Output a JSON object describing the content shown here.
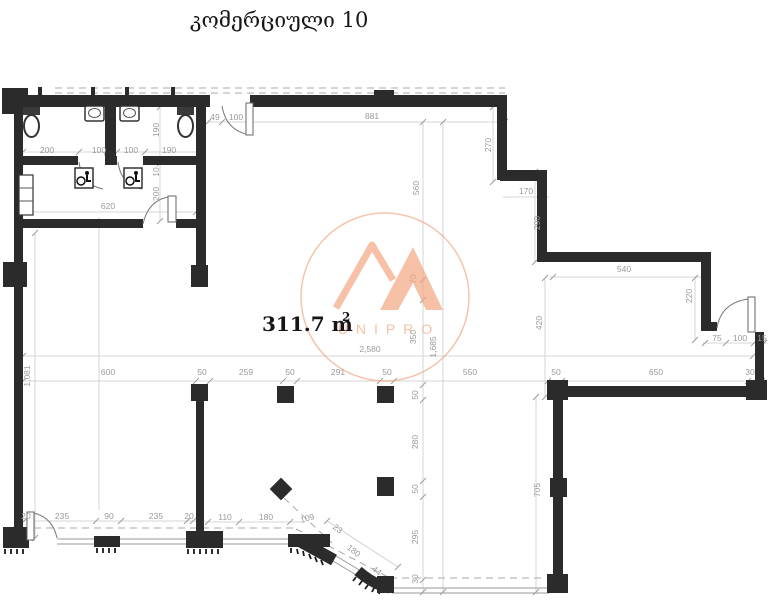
{
  "title": "კომერციული 10",
  "area_label": {
    "value": "311.7 m",
    "superscript": "2"
  },
  "watermark": {
    "brand": "UNIPRO"
  },
  "colors": {
    "wall": "#2b2b2b",
    "dimension_text": "#9a9a9a",
    "reference_line": "#c9c9c9",
    "dashed_line": "#a9a9a9",
    "watermark_orange": "#f2a47c",
    "watermark_circle": "#ec9e74"
  },
  "dimensions": [
    {
      "v": "200",
      "x": 47,
      "y": 153
    },
    {
      "v": "100",
      "x": 99,
      "y": 153
    },
    {
      "v": "100",
      "x": 131,
      "y": 153
    },
    {
      "v": "190",
      "x": 169,
      "y": 153
    },
    {
      "v": "190",
      "x": 159,
      "y": 130,
      "r": -90
    },
    {
      "v": "10",
      "x": 159,
      "y": 172,
      "r": -90
    },
    {
      "v": "200",
      "x": 159,
      "y": 194,
      "r": -90
    },
    {
      "v": "620",
      "x": 108,
      "y": 209
    },
    {
      "v": "49",
      "x": 215,
      "y": 120
    },
    {
      "v": "100",
      "x": 236,
      "y": 120
    },
    {
      "v": "881",
      "x": 372,
      "y": 119
    },
    {
      "v": "270",
      "x": 491,
      "y": 145,
      "r": -90
    },
    {
      "v": "560",
      "x": 419,
      "y": 188,
      "r": -90
    },
    {
      "v": "170",
      "x": 526,
      "y": 194
    },
    {
      "v": "290",
      "x": 540,
      "y": 223,
      "r": -90
    },
    {
      "v": "540",
      "x": 624,
      "y": 272
    },
    {
      "v": "220",
      "x": 692,
      "y": 296,
      "r": -90
    },
    {
      "v": "420",
      "x": 542,
      "y": 323,
      "r": -90
    },
    {
      "v": "75",
      "x": 717,
      "y": 341
    },
    {
      "v": "100",
      "x": 740,
      "y": 341
    },
    {
      "v": "15",
      "x": 762,
      "y": 341
    },
    {
      "v": "70",
      "x": 416,
      "y": 279,
      "r": -90
    },
    {
      "v": "350",
      "x": 416,
      "y": 337,
      "r": -90
    },
    {
      "v": "1,685",
      "x": 436,
      "y": 347,
      "r": -90
    },
    {
      "v": "2,580",
      "x": 370,
      "y": 352
    },
    {
      "v": "1,081",
      "x": 30,
      "y": 376,
      "r": -90
    },
    {
      "v": "600",
      "x": 108,
      "y": 375
    },
    {
      "v": "50",
      "x": 202,
      "y": 375
    },
    {
      "v": "259",
      "x": 246,
      "y": 375
    },
    {
      "v": "50",
      "x": 290,
      "y": 375
    },
    {
      "v": "291",
      "x": 338,
      "y": 375
    },
    {
      "v": "50",
      "x": 387,
      "y": 375
    },
    {
      "v": "550",
      "x": 470,
      "y": 375
    },
    {
      "v": "50",
      "x": 556,
      "y": 375
    },
    {
      "v": "650",
      "x": 656,
      "y": 375
    },
    {
      "v": "30",
      "x": 750,
      "y": 375
    },
    {
      "v": "50",
      "x": 418,
      "y": 395,
      "r": -90
    },
    {
      "v": "280",
      "x": 418,
      "y": 442,
      "r": -90
    },
    {
      "v": "50",
      "x": 418,
      "y": 489,
      "r": -90
    },
    {
      "v": "295",
      "x": 418,
      "y": 537,
      "r": -90
    },
    {
      "v": "30",
      "x": 418,
      "y": 579,
      "r": -90
    },
    {
      "v": "705",
      "x": 540,
      "y": 490,
      "r": -90
    },
    {
      "v": "20",
      "x": 26,
      "y": 519
    },
    {
      "v": "235",
      "x": 62,
      "y": 519
    },
    {
      "v": "90",
      "x": 109,
      "y": 519
    },
    {
      "v": "235",
      "x": 156,
      "y": 519
    },
    {
      "v": "20",
      "x": 189,
      "y": 519
    },
    {
      "v": "110",
      "x": 225,
      "y": 520
    },
    {
      "v": "180",
      "x": 266,
      "y": 520
    },
    {
      "v": "109",
      "x": 308,
      "y": 521,
      "r": -15
    },
    {
      "v": "23",
      "x": 336,
      "y": 531,
      "r": 38
    },
    {
      "v": "180",
      "x": 352,
      "y": 553,
      "r": 38
    },
    {
      "v": "44",
      "x": 375,
      "y": 573,
      "r": 38
    }
  ]
}
